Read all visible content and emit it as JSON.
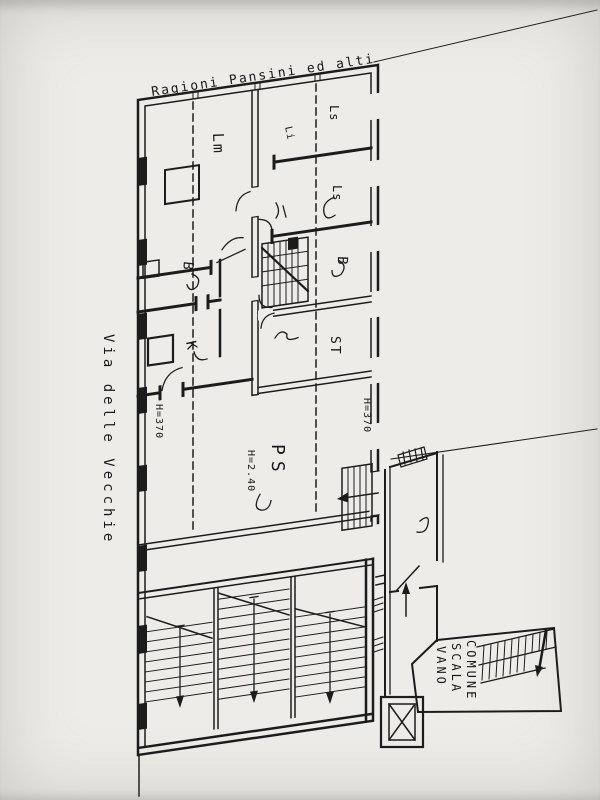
{
  "scan": {
    "paper_color": "#edece8",
    "ink_color": "#1c1c1c"
  },
  "annotations": {
    "boundary_top": "Ragioni Pansini ed alti",
    "street_left": "Via delle Vecchie"
  },
  "rooms": {
    "lm": "Lm",
    "li": "Li",
    "ls_top": "Ls",
    "ls_mid": "Ls",
    "b_left": "B",
    "b_right": "B",
    "k": "K",
    "st": "ST",
    "ps": "PS"
  },
  "heights": {
    "ps": "H=2.40",
    "left": "H=370",
    "right": "H=370"
  },
  "common_stair": {
    "line1": "VANO",
    "line2": "SCALA",
    "line3": "COMUNE"
  }
}
